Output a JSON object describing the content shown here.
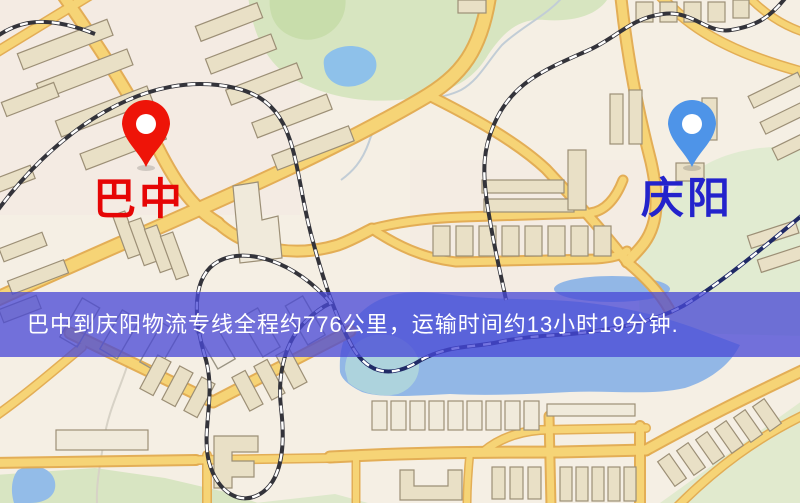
{
  "map": {
    "type": "street-map",
    "markers": [
      {
        "id": "bazhong",
        "label": "巴中",
        "pin_color": "#ee1408",
        "label_color": "#e60505",
        "position": "upper-left"
      },
      {
        "id": "qingyang",
        "label": "庆阳",
        "pin_color": "#4e94e8",
        "label_color": "#2323cc",
        "position": "upper-right"
      }
    ],
    "banner": {
      "text": "巴中到庆阳物流专线全程约776公里，运输时间约13小时19分钟.",
      "bg_color": "#4848d6",
      "text_color": "#ffffff"
    },
    "palette": {
      "background": "#f5efe4",
      "road": "#f6d476",
      "road_casing": "#e2aa4e",
      "building": "#e9e0c6",
      "park": "#d7e5c0",
      "water": "#92b7e6",
      "railway": "#33333a"
    }
  }
}
